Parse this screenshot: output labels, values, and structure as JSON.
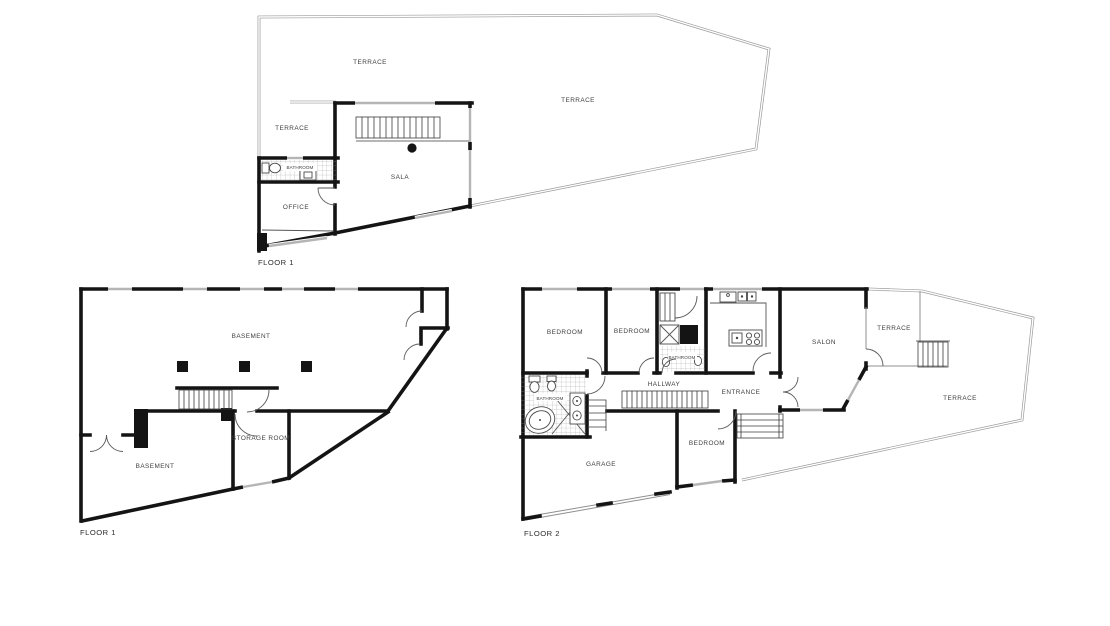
{
  "document": {
    "type": "architectural floor plans",
    "background": "#ffffff",
    "wall_color": "#141414",
    "boundary_color": "#9a9a9a",
    "window_color": "#b5b5b5",
    "text_color": "#3f3f3f"
  },
  "plans": {
    "floor1_upper": {
      "label": "FLOOR 1",
      "rooms": {
        "terrace_top": "TERRACE",
        "terrace_right": "TERRACE",
        "terrace_left": "TERRACE",
        "bathroom": "BATHROOM",
        "sala": "SALA",
        "office": "OFFICE"
      }
    },
    "floor1_basement": {
      "label": "FLOOR 1",
      "rooms": {
        "basement_main": "BASEMENT",
        "basement_lower": "BASEMENT",
        "storage_room": "STORAGE ROOM"
      }
    },
    "floor2": {
      "label": "FLOOR 2",
      "rooms": {
        "bedroom_1": "BEDROOM",
        "bedroom_2": "BEDROOM",
        "bathroom_upper": "BATHROOM",
        "salon": "SALON",
        "terrace_upper": "TERRACE",
        "hallway": "HALLWAY",
        "entrance": "ENTRANCE",
        "bathroom_main": "BATHROOM",
        "garage": "GARAGE",
        "bedroom_3": "BEDROOM",
        "terrace_main": "TERRACE"
      }
    }
  }
}
